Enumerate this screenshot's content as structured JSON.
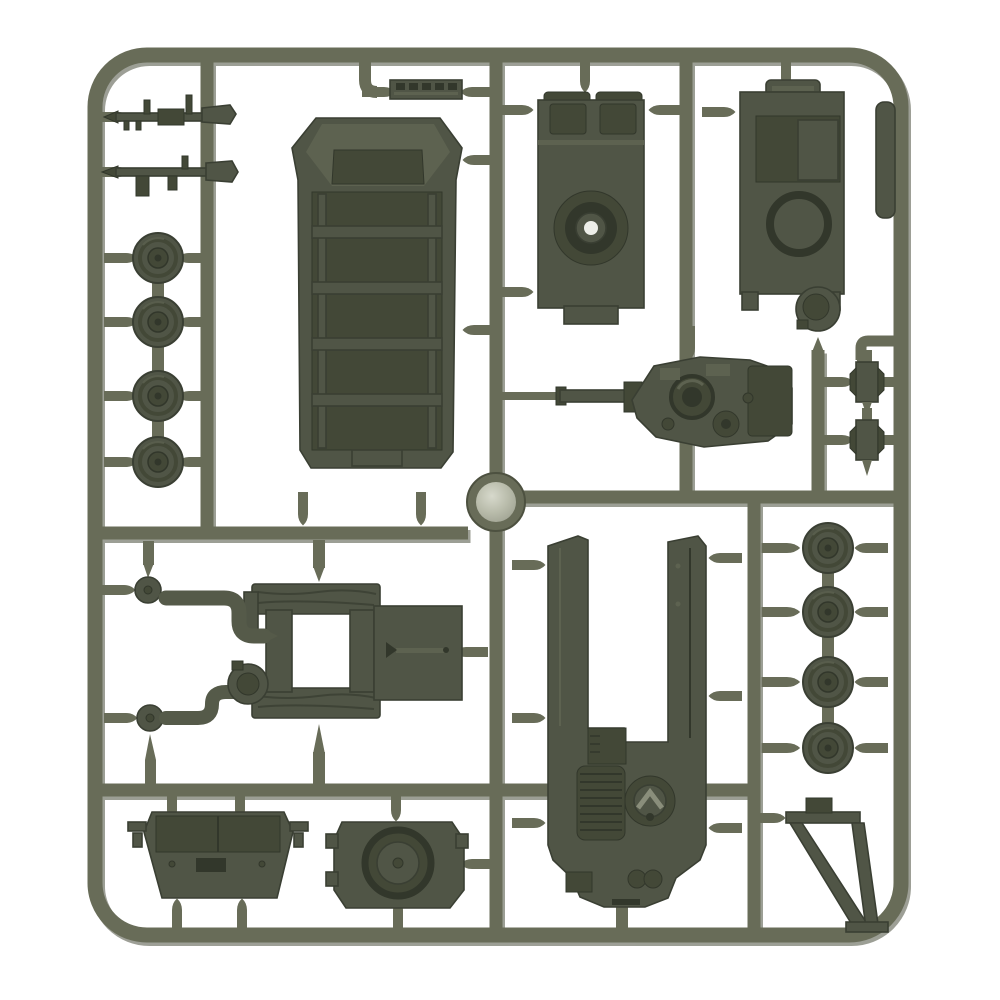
{
  "meta": {
    "title": "Plastic model sprue",
    "description": "Olive drab injection-molded plastic sprue holding 15mm miniature tank model parts - hull halves, turret decks, road wheels, machine guns, hatches and an A-frame - photographed on a white background"
  },
  "colors": {
    "bg": "#ffffff",
    "sprue": "#686c58",
    "sprue-sh": "#4d5140",
    "part": "#50554660",
    "part2": "#505546",
    "part-edge": "#3a3f33",
    "part-dark": "#434837",
    "detail": "#32372b",
    "plight": "#5d6250",
    "hl": "#8a8e7b",
    "pipe": "#555a49",
    "gate-core": "#b9bcab",
    "gate-hi": "#d7d9cc",
    "hole": "#edeee8"
  },
  "parts": [
    {
      "name": "sprue-frame",
      "count": 1
    },
    {
      "name": "machine-gun-upper",
      "count": 1
    },
    {
      "name": "machine-gun-lower",
      "count": 1
    },
    {
      "name": "road-wheel-left-column",
      "count": 4
    },
    {
      "name": "track-section",
      "count": 1
    },
    {
      "name": "apc-hull-top",
      "count": 1
    },
    {
      "name": "hull-deck-turret-ring",
      "count": 1
    },
    {
      "name": "hull-deck-hatch",
      "count": 1
    },
    {
      "name": "commander-cupola",
      "count": 1
    },
    {
      "name": "mounting-tab",
      "count": 1
    },
    {
      "name": "turret-with-gun",
      "count": 1
    },
    {
      "name": "small-bracket",
      "count": 2
    },
    {
      "name": "injection-gate-disc",
      "count": 1
    },
    {
      "name": "hatch-frame",
      "count": 1
    },
    {
      "name": "hatch-door",
      "count": 1
    },
    {
      "name": "exhaust-elbow",
      "count": 2
    },
    {
      "name": "hub-disc",
      "count": 2
    },
    {
      "name": "observation-cupola",
      "count": 1
    },
    {
      "name": "engine-deck-hull",
      "count": 1
    },
    {
      "name": "turret-roof-trapezoid",
      "count": 1
    },
    {
      "name": "round-turret-top",
      "count": 1
    },
    {
      "name": "road-wheel-right-column",
      "count": 4
    },
    {
      "name": "a-frame-jack",
      "count": 1
    }
  ]
}
